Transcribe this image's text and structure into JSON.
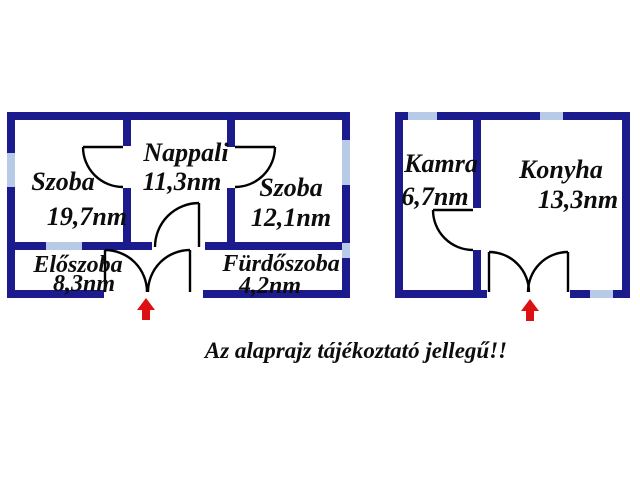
{
  "caption": "Az alaprajz tájékoztató jellegű!!",
  "colors": {
    "wall": "#1b1b8d",
    "window": "#b7cbe9",
    "door_line": "#000000",
    "entrance_arrow": "#dd1111",
    "text": "#0d0d0d",
    "background": "#ffffff"
  },
  "buildings": {
    "main": {
      "rooms": {
        "szoba1": {
          "name": "Szoba",
          "area": "19,7nm"
        },
        "nappali": {
          "name": "Nappali",
          "area": "11,3nm"
        },
        "szoba2": {
          "name": "Szoba",
          "area": "12,1nm"
        },
        "eloszoba": {
          "name": "Előszoba",
          "area": "8,3nm"
        },
        "furdoszoba": {
          "name": "Fürdőszoba",
          "area": "4,2nm"
        }
      }
    },
    "annex": {
      "rooms": {
        "kamra": {
          "name": "Kamra",
          "area": "6,7nm"
        },
        "konyha": {
          "name": "Konyha",
          "area": "13,3nm"
        }
      }
    }
  }
}
